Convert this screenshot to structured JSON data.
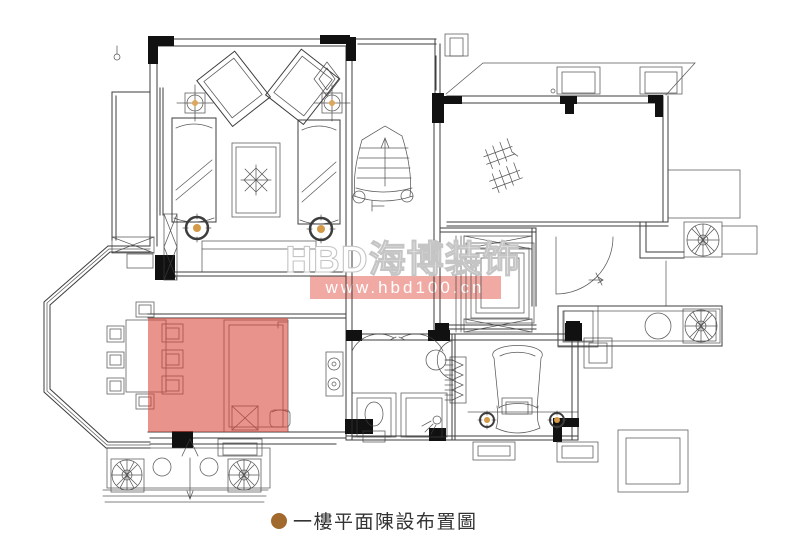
{
  "watermark": {
    "brand": "HBD海博装饰",
    "url": "www.hbd100.cn"
  },
  "caption": {
    "text": "一樓平面陳設布置圖"
  },
  "colors": {
    "line": "#3d3d3d",
    "ink": "#111111",
    "accent": "#d49a48",
    "highlight": "#d9453a",
    "watermark_bar": "#f1aaa3",
    "wm_outline": "#c5c5c5",
    "bullet": "#a2692d",
    "caption_ink": "#333333",
    "background": "#ffffff"
  }
}
